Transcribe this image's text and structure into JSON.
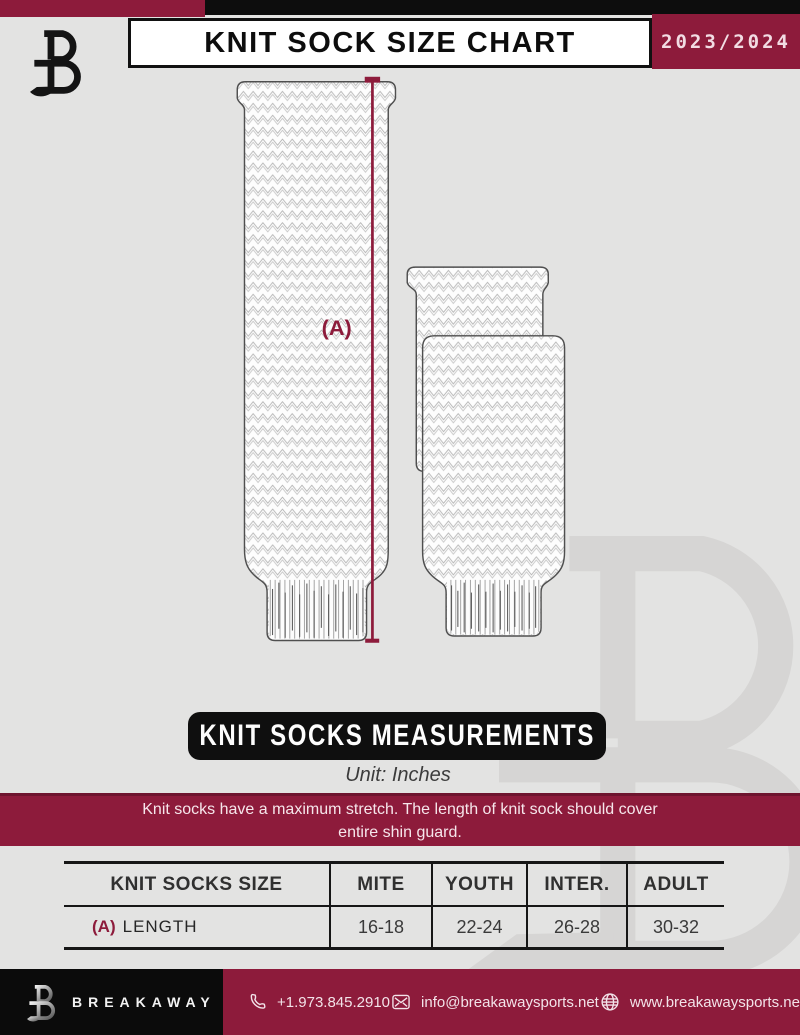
{
  "header": {
    "title": "KNIT SOCK SIZE CHART",
    "season": "2023/2024"
  },
  "diagram": {
    "label_a": "(A)"
  },
  "measurements_banner": {
    "title": "KNIT SOCKS MEASUREMENTS",
    "unit": "Unit: Inches"
  },
  "notice": {
    "line1": "Knit socks have a maximum stretch. The length of knit sock should cover",
    "line2": "entire shin guard."
  },
  "size_table": {
    "headers": [
      "KNIT SOCKS SIZE",
      "MITE",
      "YOUTH",
      "INTER.",
      "ADULT"
    ],
    "row": {
      "prefix": "(A)",
      "label": "LENGTH",
      "values": [
        "16-18",
        "22-24",
        "26-28",
        "30-32"
      ]
    }
  },
  "footer": {
    "brand": "BREAKAWAY",
    "phone": "+1.973.845.2910",
    "email": "info@breakawaysports.net",
    "website": "www.breakawaysports.net"
  },
  "colors": {
    "maroon": "#8D1B3B",
    "black": "#0D0D0D",
    "background": "#E3E3E2",
    "light_pink_text": "#F3E3E9",
    "watermark_gray": "#D6D5D4"
  },
  "icons": {
    "brand_mark": "breakaway-b-logo",
    "phone": "phone-icon",
    "email": "envelope-icon",
    "website": "globe-icon",
    "watermark": "breakaway-b-watermark"
  }
}
